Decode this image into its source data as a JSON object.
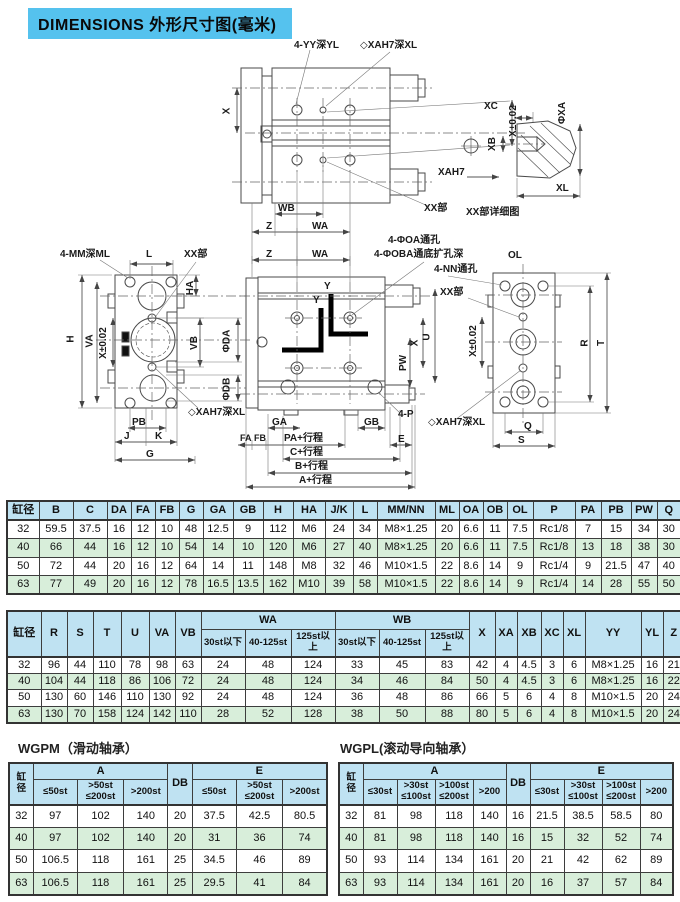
{
  "title": "DIMENSIONS 外形尺寸图(毫米)",
  "drawing": {
    "top": {
      "yy": "4-YY深YL",
      "xah7": "◇XAH7深XL",
      "x": "X",
      "xtol": "X±0.02",
      "wb": "WB",
      "z1": "Z",
      "wa1": "WA",
      "z2": "Z",
      "wa2": "WA",
      "xx": "XX部",
      "xah7_pin": "XAH7"
    },
    "detail": {
      "xc": "XC",
      "xa": "ΦXA",
      "xb": "XB",
      "xl": "XL",
      "caption": "XX部详细图"
    },
    "left": {
      "mm": "4-MM深ML",
      "l": "L",
      "xx": "XX部",
      "h": "H",
      "va": "VA",
      "xtol": "X±0.02",
      "ha": "HA",
      "vb": "VB",
      "da": "ΦDA",
      "db": "ΦDB",
      "xah7": "◇XAH7深XL",
      "pb": "PB",
      "j": "J",
      "k": "K",
      "g": "G"
    },
    "front": {
      "oa": "4-ΦOA通孔",
      "ob": "4-ΦOBA通底扩孔深",
      "ol": "OL",
      "nn": "4-NN通孔",
      "xx": "XX部",
      "u": "U",
      "x": "X",
      "pw": "PW",
      "y1": "Y",
      "y2": "Y",
      "p": "4-P",
      "xah7": "◇XAH7深XL",
      "ga": "GA",
      "gb": "GB",
      "fa": "FA",
      "fb": "FB",
      "pa": "PA+行程",
      "c": "C+行程",
      "b": "B+行程",
      "a": "A+行程",
      "e": "E"
    },
    "right": {
      "xtol": "X±0.02",
      "r": "R",
      "t": "T",
      "q": "Q",
      "s": "S"
    }
  },
  "table1": {
    "headers": [
      "缸径",
      "B",
      "C",
      "DA",
      "FA",
      "FB",
      "G",
      "GA",
      "GB",
      "H",
      "HA",
      "J/K",
      "L",
      "MM/NN",
      "ML",
      "OA",
      "OB",
      "OL",
      "P",
      "PA",
      "PB",
      "PW",
      "Q"
    ],
    "rows": [
      [
        "32",
        "59.5",
        "37.5",
        "16",
        "12",
        "10",
        "48",
        "12.5",
        "9",
        "112",
        "M6",
        "24",
        "34",
        "M8×1.25",
        "20",
        "6.6",
        "11",
        "7.5",
        "Rc1/8",
        "7",
        "15",
        "34",
        "30"
      ],
      [
        "40",
        "66",
        "44",
        "16",
        "12",
        "10",
        "54",
        "14",
        "10",
        "120",
        "M6",
        "27",
        "40",
        "M8×1.25",
        "20",
        "6.6",
        "11",
        "7.5",
        "Rc1/8",
        "13",
        "18",
        "38",
        "30"
      ],
      [
        "50",
        "72",
        "44",
        "20",
        "16",
        "12",
        "64",
        "14",
        "11",
        "148",
        "M8",
        "32",
        "46",
        "M10×1.5",
        "22",
        "8.6",
        "14",
        "9",
        "Rc1/4",
        "9",
        "21.5",
        "47",
        "40"
      ],
      [
        "63",
        "77",
        "49",
        "20",
        "16",
        "12",
        "78",
        "16.5",
        "13.5",
        "162",
        "M10",
        "39",
        "58",
        "M10×1.5",
        "22",
        "8.6",
        "14",
        "9",
        "Rc1/4",
        "14",
        "28",
        "55",
        "50"
      ]
    ]
  },
  "table2": {
    "h": {
      "bore": "缸径",
      "r": "R",
      "s": "S",
      "t": "T",
      "u": "U",
      "va": "VA",
      "vb": "VB",
      "wa": "WA",
      "wb": "WB",
      "s1": "30st以下",
      "s2": "40-125st",
      "s3": "125st以上",
      "x": "X",
      "xa": "XA",
      "xb": "XB",
      "xc": "XC",
      "xl": "XL",
      "yy": "YY",
      "yl": "YL",
      "z": "Z"
    },
    "rows": [
      [
        "32",
        "96",
        "44",
        "110",
        "78",
        "98",
        "63",
        "24",
        "48",
        "124",
        "33",
        "45",
        "83",
        "42",
        "4",
        "4.5",
        "3",
        "6",
        "M8×1.25",
        "16",
        "21"
      ],
      [
        "40",
        "104",
        "44",
        "118",
        "86",
        "106",
        "72",
        "24",
        "48",
        "124",
        "34",
        "46",
        "84",
        "50",
        "4",
        "4.5",
        "3",
        "6",
        "M8×1.25",
        "16",
        "22"
      ],
      [
        "50",
        "130",
        "60",
        "146",
        "110",
        "130",
        "92",
        "24",
        "48",
        "124",
        "36",
        "48",
        "86",
        "66",
        "5",
        "6",
        "4",
        "8",
        "M10×1.5",
        "20",
        "24"
      ],
      [
        "63",
        "130",
        "70",
        "158",
        "124",
        "142",
        "110",
        "28",
        "52",
        "128",
        "38",
        "50",
        "88",
        "80",
        "5",
        "6",
        "4",
        "8",
        "M10×1.5",
        "20",
        "24"
      ]
    ]
  },
  "wgpm": {
    "title": "WGPM（滑动轴承）",
    "h": {
      "bore": "缸\n径",
      "a": "A",
      "db": "DB",
      "e": "E",
      "s1": "≤50st",
      "s2": ">50st\n≤200st",
      "s3": ">200st"
    },
    "rows": [
      [
        "32",
        "97",
        "102",
        "140",
        "20",
        "37.5",
        "42.5",
        "80.5"
      ],
      [
        "40",
        "97",
        "102",
        "140",
        "20",
        "31",
        "36",
        "74"
      ],
      [
        "50",
        "106.5",
        "118",
        "161",
        "25",
        "34.5",
        "46",
        "89"
      ],
      [
        "63",
        "106.5",
        "118",
        "161",
        "25",
        "29.5",
        "41",
        "84"
      ]
    ]
  },
  "wgpl": {
    "title": "WGPL(滚动导向轴承）",
    "h": {
      "bore": "缸\n径",
      "a": "A",
      "db": "DB",
      "e": "E",
      "s1": "≤30st",
      "s2": ">30st\n≤100st",
      "s3": ">100st\n≤200st",
      "s4": ">200"
    },
    "rows": [
      [
        "32",
        "81",
        "98",
        "118",
        "140",
        "16",
        "21.5",
        "38.5",
        "58.5",
        "80"
      ],
      [
        "40",
        "81",
        "98",
        "118",
        "140",
        "16",
        "15",
        "32",
        "52",
        "74"
      ],
      [
        "50",
        "93",
        "114",
        "134",
        "161",
        "20",
        "21",
        "42",
        "62",
        "89"
      ],
      [
        "63",
        "93",
        "114",
        "134",
        "161",
        "20",
        "16",
        "37",
        "57",
        "84"
      ]
    ]
  }
}
